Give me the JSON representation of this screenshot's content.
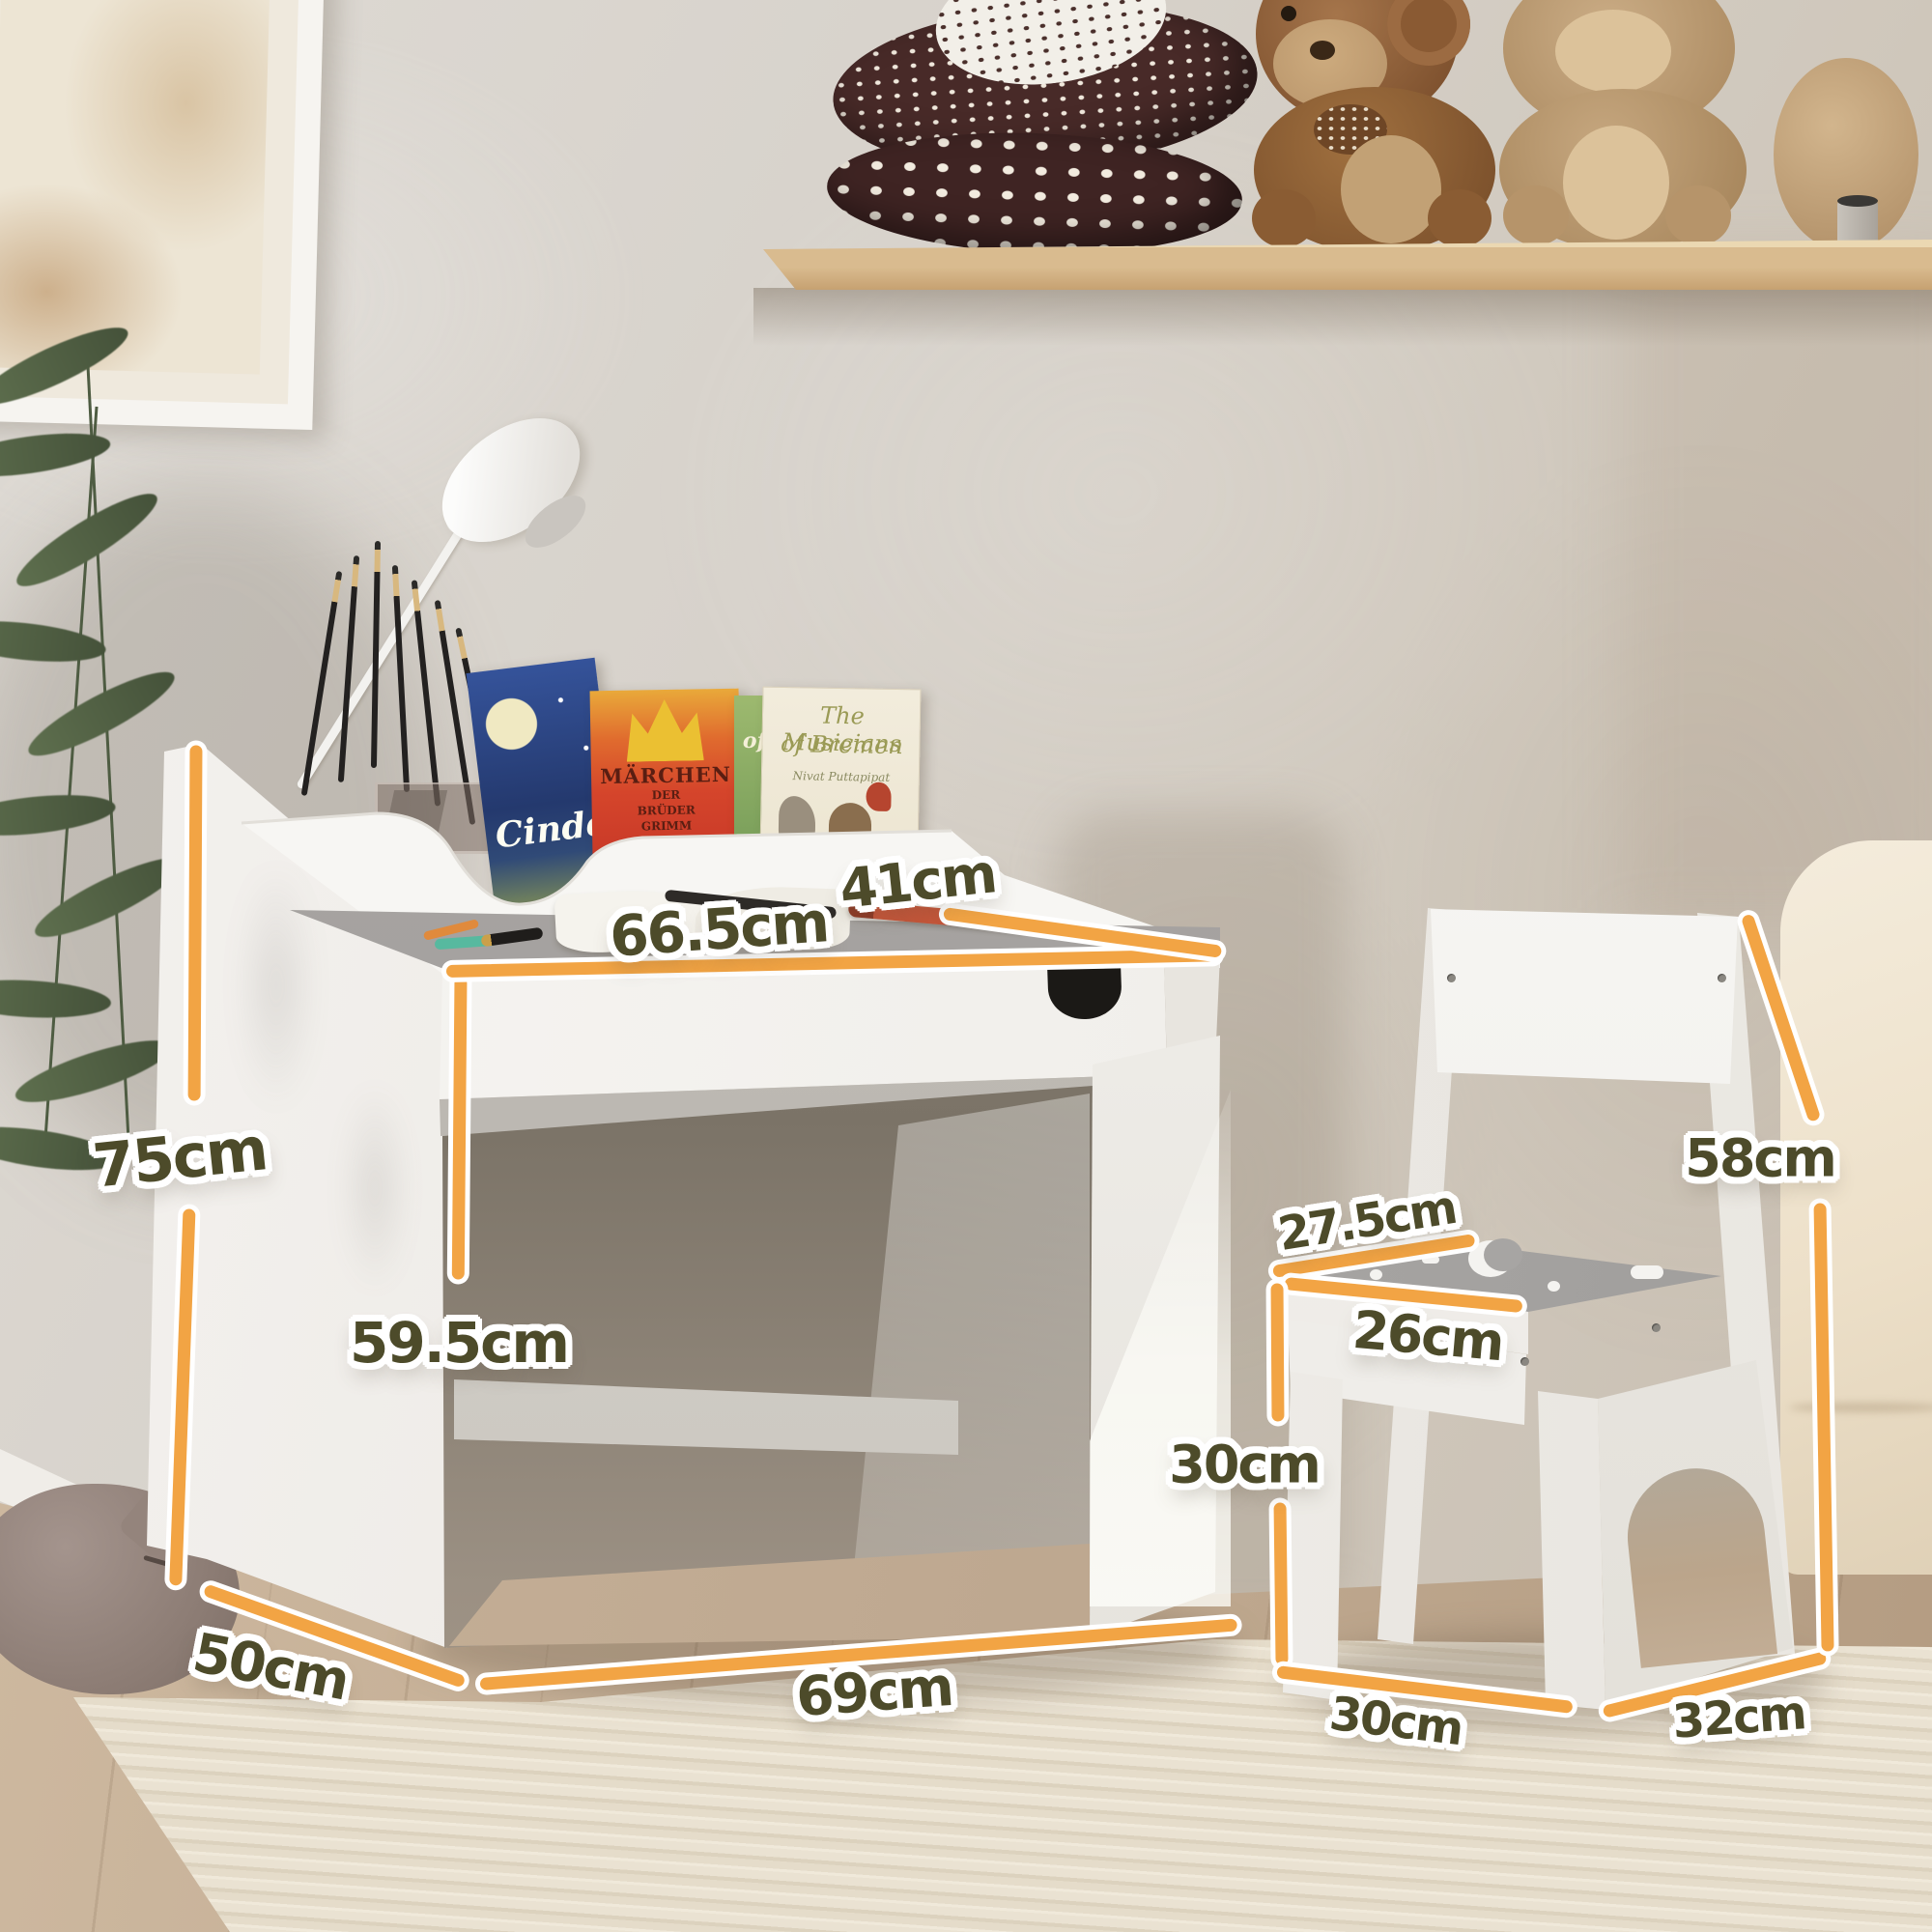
{
  "colors": {
    "dimension_line": "#F2A444",
    "dimension_label": "#4D4B2A",
    "furniture": "#F5F4F1"
  },
  "dimensions": {
    "unit": "cm",
    "labels": [
      {
        "id": "desk-top-depth",
        "text": "41cm"
      },
      {
        "id": "desk-top-width",
        "text": "66.5cm"
      },
      {
        "id": "desk-total-height",
        "text": "75cm"
      },
      {
        "id": "desk-clearance-height",
        "text": "59.5cm"
      },
      {
        "id": "desk-floor-depth",
        "text": "50cm"
      },
      {
        "id": "desk-floor-width",
        "text": "69cm"
      },
      {
        "id": "chair-seat-depth",
        "text": "27.5cm"
      },
      {
        "id": "chair-seat-width",
        "text": "26cm"
      },
      {
        "id": "chair-back-height",
        "text": "58cm"
      },
      {
        "id": "chair-seat-height",
        "text": "30cm"
      },
      {
        "id": "chair-floor-width",
        "text": "30cm"
      },
      {
        "id": "chair-floor-depth",
        "text": "32cm"
      }
    ]
  },
  "books": [
    {
      "title": "Cinde"
    },
    {
      "title_lines": [
        "MÄRCHEN",
        "DER",
        "BRÜDER",
        "GRIMM"
      ]
    },
    {
      "title": "of"
    },
    {
      "title_lines": [
        "The Musicians",
        "of Bremen"
      ],
      "author": "Nivat Puttapipat"
    }
  ]
}
